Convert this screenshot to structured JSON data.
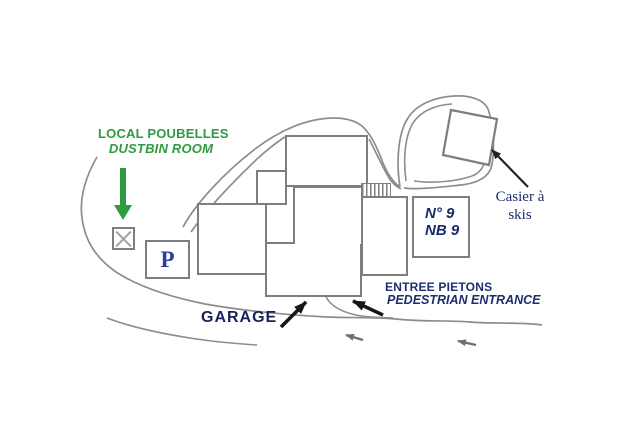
{
  "labels": {
    "dustbin_fr": "LOCAL POUBELLES",
    "dustbin_en": "DUSTBIN ROOM",
    "parking": "P",
    "building_no_line1": "N° 9",
    "building_no_line2": "NB 9",
    "ski_locker_line1": "Casier à",
    "ski_locker_line2": "skis",
    "garage": "GARAGE",
    "entrance_fr": "ENTREE PIETONS",
    "entrance_en": "PEDESTRIAN ENTRANCE"
  },
  "colors": {
    "label_green": "#2e9b3c",
    "label_navy": "#1c2f6e",
    "garage_navy": "#1b2157",
    "parking_blue": "#2b3f96",
    "building_outline_gray": "#7e7e7e",
    "road_gray": "#8d8d8d",
    "arrow_black": "#161616",
    "arrow_gray": "#6f6f6f",
    "background": "#ffffff"
  }
}
